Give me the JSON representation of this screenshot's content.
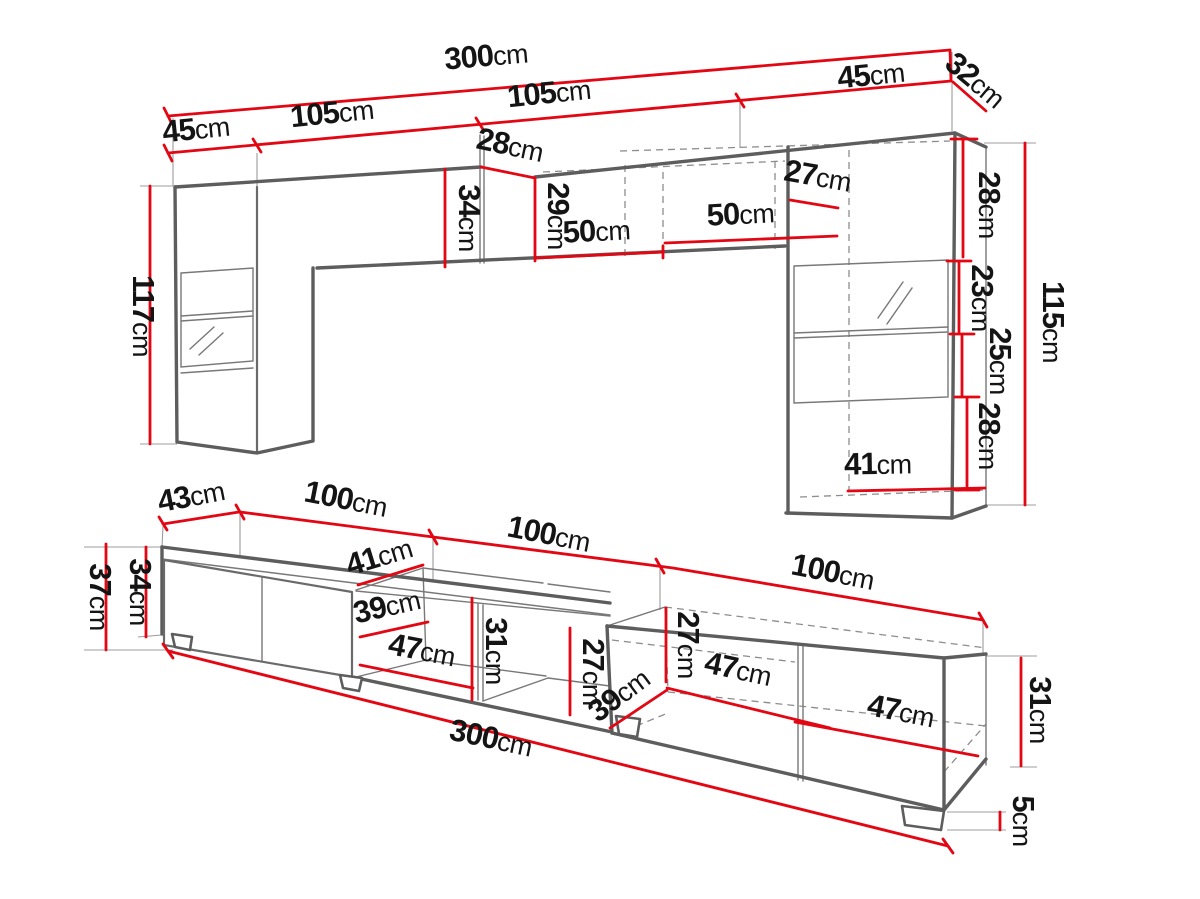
{
  "palette": {
    "dimension_red": "#e30613",
    "furniture_gray": "#5d5d5d",
    "text_black": "#141414",
    "background": "#ffffff"
  },
  "unit_label": "cm",
  "wall_unit": {
    "dims": [
      {
        "v": "300",
        "u": "cm"
      },
      {
        "v": "45",
        "u": "cm"
      },
      {
        "v": "105",
        "u": "cm"
      },
      {
        "v": "105",
        "u": "cm"
      },
      {
        "v": "45",
        "u": "cm"
      },
      {
        "v": "32",
        "u": "cm"
      },
      {
        "v": "28",
        "u": "cm"
      },
      {
        "v": "34",
        "u": "cm"
      },
      {
        "v": "29",
        "u": "cm"
      },
      {
        "v": "50",
        "u": "cm"
      },
      {
        "v": "50",
        "u": "cm"
      },
      {
        "v": "27",
        "u": "cm"
      },
      {
        "v": "117",
        "u": "cm"
      },
      {
        "v": "28",
        "u": "cm"
      },
      {
        "v": "23",
        "u": "cm"
      },
      {
        "v": "25",
        "u": "cm"
      },
      {
        "v": "28",
        "u": "cm"
      },
      {
        "v": "115",
        "u": "cm"
      },
      {
        "v": "41",
        "u": "cm"
      }
    ]
  },
  "tv_stand": {
    "dims": [
      {
        "v": "43",
        "u": "cm"
      },
      {
        "v": "100",
        "u": "cm"
      },
      {
        "v": "100",
        "u": "cm"
      },
      {
        "v": "100",
        "u": "cm"
      },
      {
        "v": "41",
        "u": "cm"
      },
      {
        "v": "39",
        "u": "cm"
      },
      {
        "v": "47",
        "u": "cm"
      },
      {
        "v": "31",
        "u": "cm"
      },
      {
        "v": "27",
        "u": "cm"
      },
      {
        "v": "27",
        "u": "cm"
      },
      {
        "v": "39",
        "u": "cm"
      },
      {
        "v": "47",
        "u": "cm"
      },
      {
        "v": "47",
        "u": "cm"
      },
      {
        "v": "37",
        "u": "cm"
      },
      {
        "v": "34",
        "u": "cm"
      },
      {
        "v": "31",
        "u": "cm"
      },
      {
        "v": "300",
        "u": "cm"
      },
      {
        "v": "5",
        "u": "cm"
      }
    ]
  }
}
